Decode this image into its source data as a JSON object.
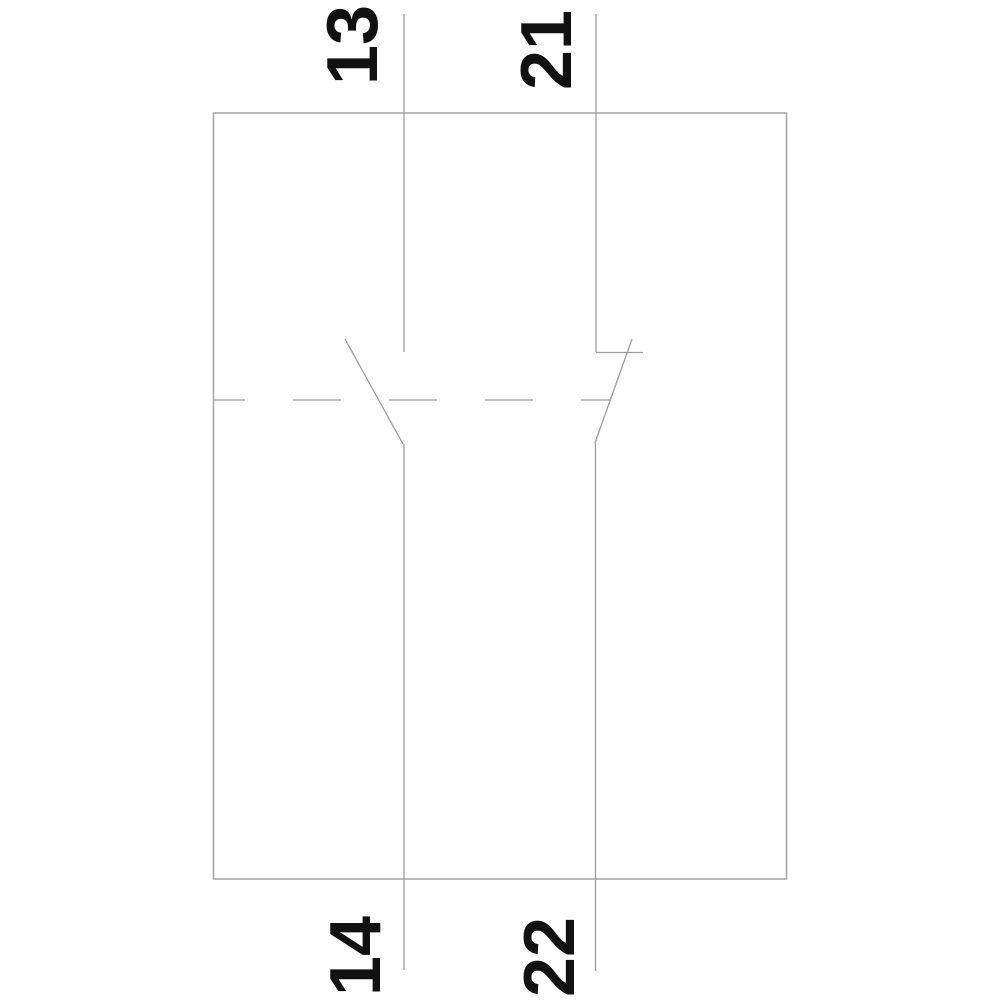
{
  "colors": {
    "background": "#ffffff",
    "outline": "#a8a8a8",
    "line": "#9d9d9d",
    "label": "#111111"
  },
  "contacts": [
    {
      "top_terminal": "13",
      "bottom_terminal": "14"
    },
    {
      "top_terminal": "21",
      "bottom_terminal": "22"
    }
  ]
}
